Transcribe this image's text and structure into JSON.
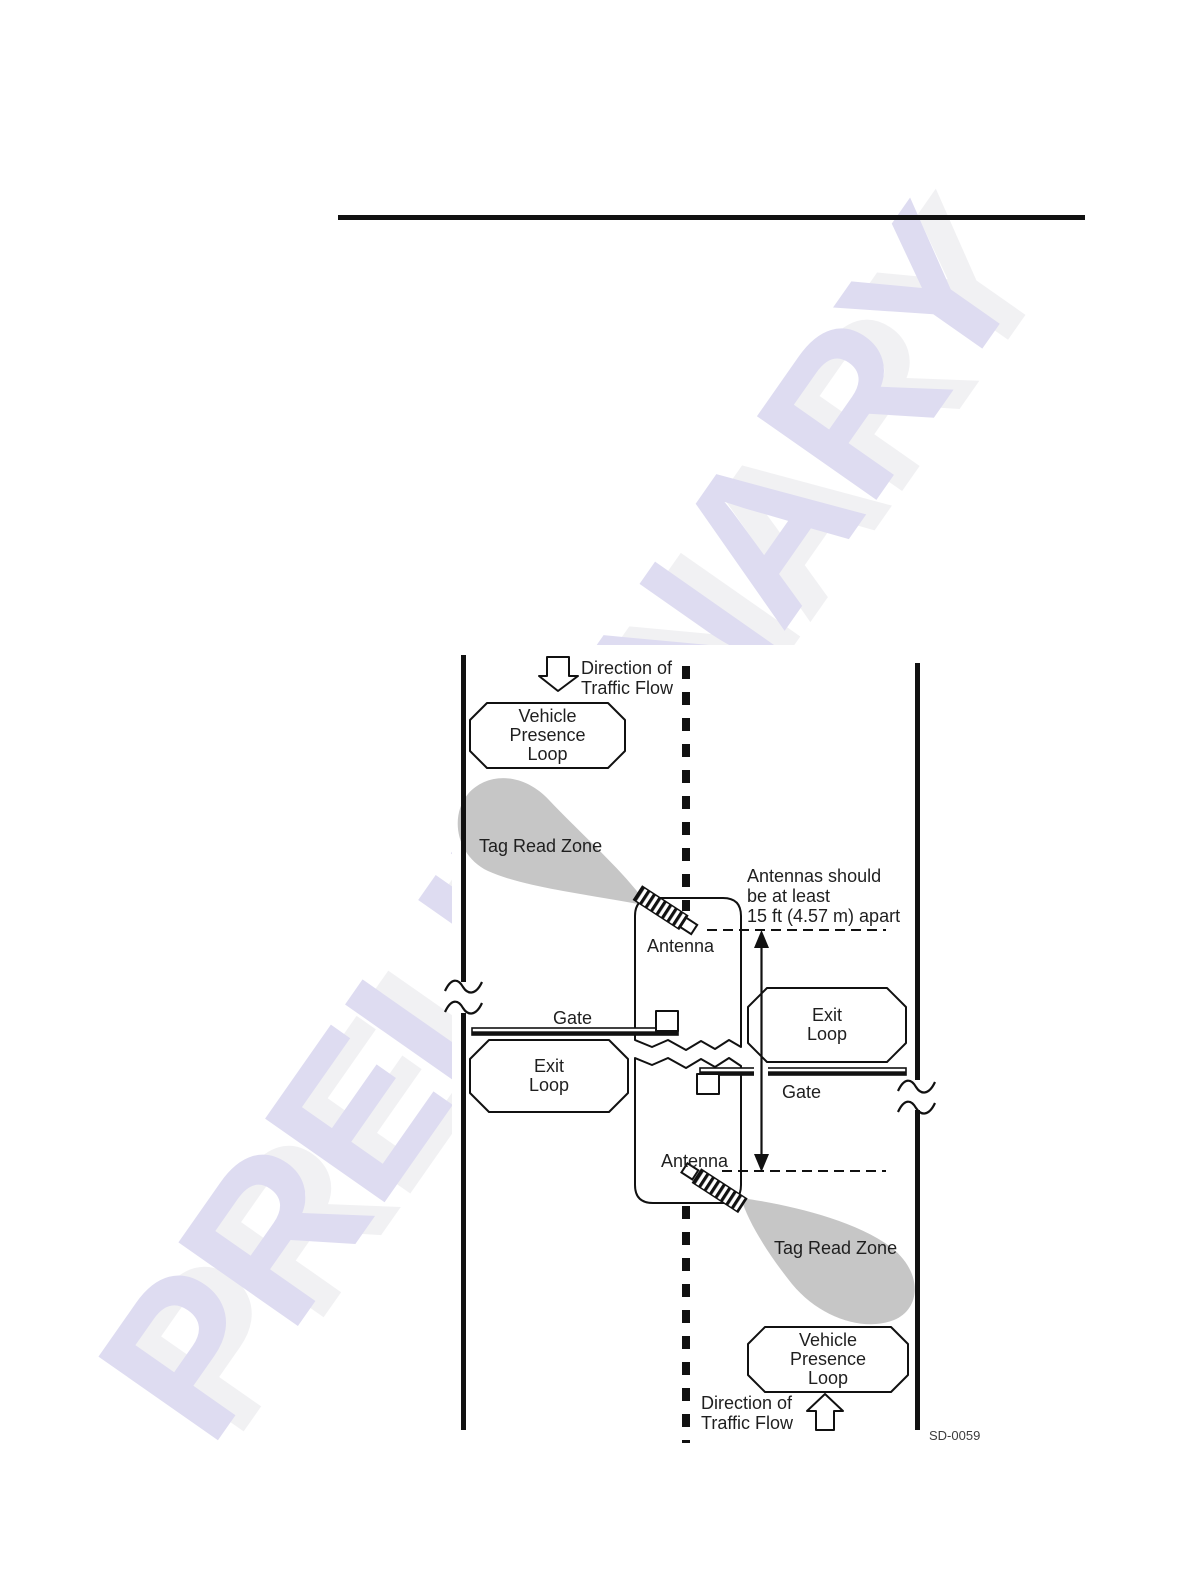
{
  "page": {
    "watermark": "PRELIMINARY",
    "figure_code": "SD-0059"
  },
  "diagram": {
    "direction_top": {
      "line1": "Direction of",
      "line2": "Traffic Flow"
    },
    "direction_bottom": {
      "line1": "Direction of",
      "line2": "Traffic Flow"
    },
    "vehicle_presence_loop_top": {
      "line1": "Vehicle",
      "line2": "Presence",
      "line3": "Loop"
    },
    "vehicle_presence_loop_bottom": {
      "line1": "Vehicle",
      "line2": "Presence",
      "line3": "Loop"
    },
    "tag_read_zone_top": "Tag Read Zone",
    "tag_read_zone_bottom": "Tag Read Zone",
    "antenna_top": "Antenna",
    "antenna_bottom": "Antenna",
    "gate_left": "Gate",
    "gate_right": "Gate",
    "exit_loop_left": {
      "line1": "Exit",
      "line2": "Loop"
    },
    "exit_loop_right": {
      "line1": "Exit",
      "line2": "Loop"
    },
    "spacing_note": {
      "line1": "Antennas should",
      "line2": "be at least",
      "line3": "15 ft (4.57 m) apart"
    }
  },
  "colors": {
    "zone_fill": "#c6c6c6",
    "watermark": "#dedcf1",
    "line": "#111111"
  }
}
